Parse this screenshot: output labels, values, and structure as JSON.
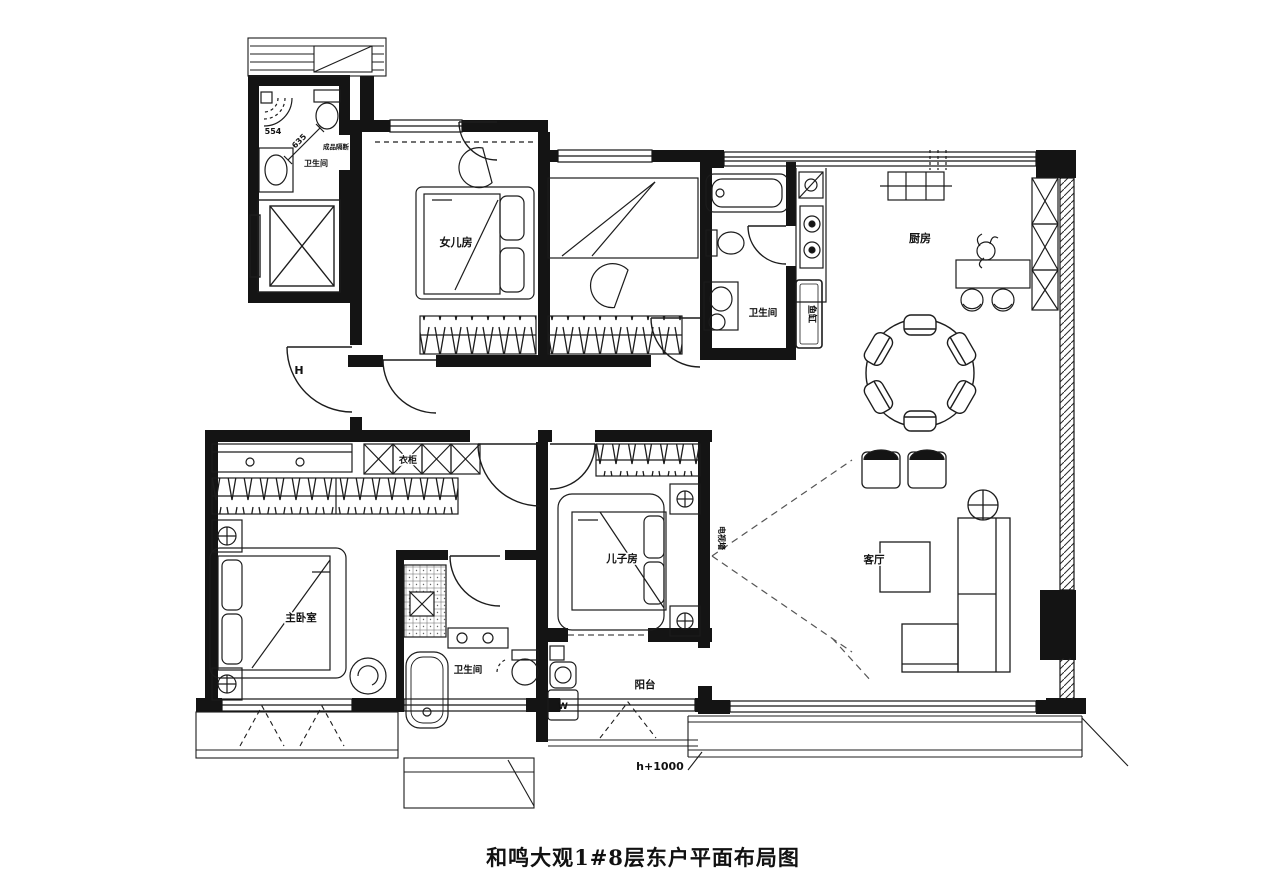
{
  "title": "和鸣大观1#8层东户平面布局图",
  "rooms": {
    "daughter_room": "女儿房",
    "master_bedroom": "主卧室",
    "son_room": "儿子房",
    "living_room": "客厅",
    "kitchen": "厨房",
    "balcony": "阳台",
    "bathroom_guest": "卫生间",
    "bathroom_hall": "卫生间",
    "bathroom_master": "卫生间"
  },
  "annotations": {
    "lobby_mark": "H",
    "dim_a": "554",
    "dim_b": "635",
    "partition_note": "成品隔断",
    "fish_tank": "鱼缸",
    "tv_wall": "电视墙",
    "wardrobe_cabinet": "衣柜",
    "washer_mark": "W",
    "sill_height": "h+1000"
  },
  "colors": {
    "line": "#161616",
    "background": "#ffffff"
  }
}
